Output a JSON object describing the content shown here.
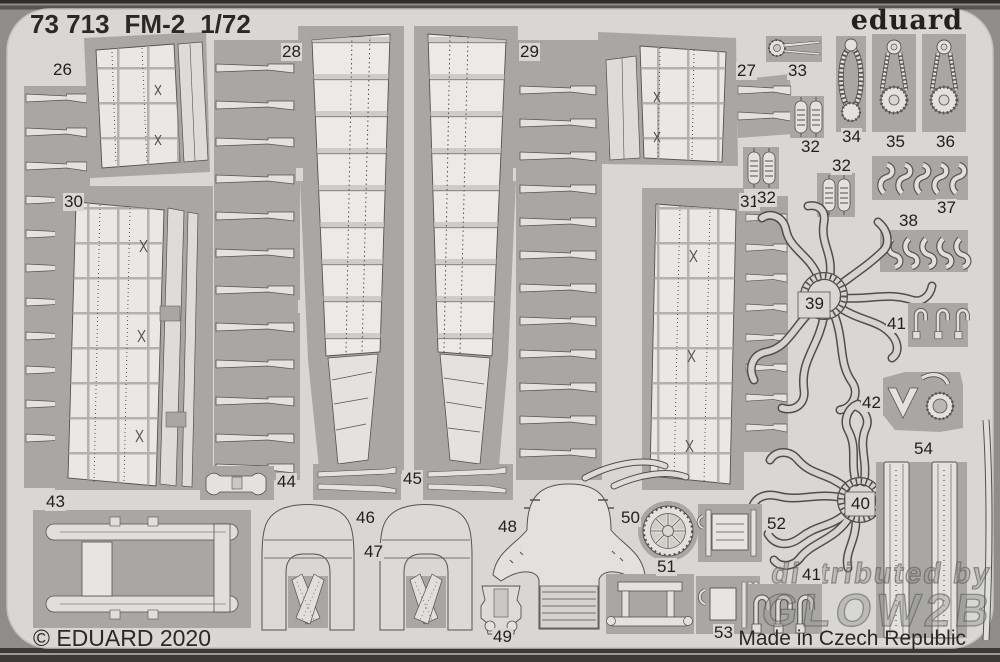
{
  "header": {
    "catalog_number": "73 713",
    "model": "FM-2",
    "scale": "1/72"
  },
  "brand": {
    "logo": "eduard"
  },
  "footer": {
    "copyright": "© EDUARD 2020",
    "origin": "Made in Czech Republic"
  },
  "watermark": {
    "line1": "distributed by",
    "line2": "GLOW2B"
  },
  "sheet": {
    "year": "2020",
    "type": "photo-etched fret"
  },
  "colors": {
    "sheet": "#d8d7d3",
    "frame_web": "#a8a7a4",
    "part_light": "#e3e2de",
    "outline": "#54534e",
    "border_band": "#3a3938"
  },
  "part_labels": {
    "p26": "26",
    "p27": "27",
    "p28": "28",
    "p29": "29",
    "p30": "30",
    "p31": "31",
    "p32a": "32",
    "p32b": "32",
    "p32c": "32",
    "p33": "33",
    "p34": "34",
    "p35": "35",
    "p36": "36",
    "p37": "37",
    "p38": "38",
    "p39": "39",
    "p40": "40",
    "p41a": "41",
    "p41b": "41",
    "p42": "42",
    "p43": "43",
    "p44": "44",
    "p45": "45",
    "p46": "46",
    "p47": "47",
    "p48": "48",
    "p49": "49",
    "p50": "50",
    "p51": "51",
    "p52": "52",
    "p53": "53",
    "p54": "54"
  }
}
